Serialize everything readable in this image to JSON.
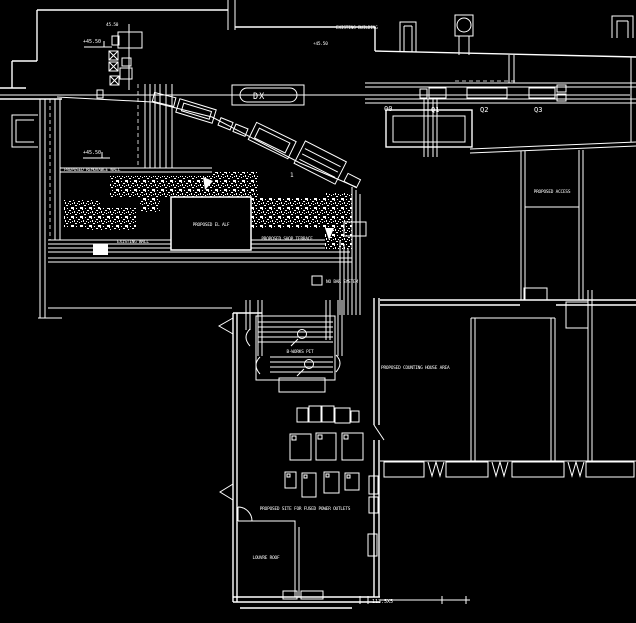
{
  "plan": {
    "colors": {
      "background": "#000000",
      "line": "#ffffff"
    },
    "labels": {
      "dx": "DX",
      "q0": "00",
      "q1": "Q1",
      "q2": "Q2",
      "q3": "Q3",
      "item1": "1",
      "level_top": "+45.50",
      "level_mid": "+45.50",
      "level_wall": "+45.50",
      "dim_top": "45.50",
      "existing_building": "EXISTING BUILDING",
      "removable_wall": "PROPOSED REMOVABLE WALL",
      "el_alf": "PROPOSED EL ALF",
      "shop_terrace": "PROPOSED SHOP TERRACE",
      "existing_wall": "EXISTING WALL",
      "no_bar": "NO BAR SYSTEM",
      "access": "PROPOSED ACCESS",
      "counting_house": "PROPOSED COUNTING HOUSE AREA",
      "pit": "B-WORKS PIT",
      "power_outlets": "PROPOSED SITE FOR FUSED POWER OUTLETS",
      "louvre_roof": "LOUVRE ROOF",
      "dim_bottom": "113.5X5"
    }
  }
}
